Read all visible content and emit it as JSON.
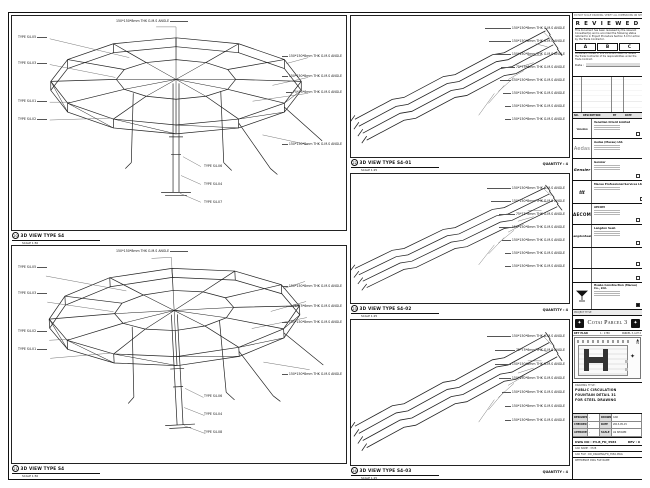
{
  "note": "DO NOT SCALE DRAWING. VERIFY ALL DIMENSIONS ON SITE.",
  "stamp": {
    "title": "R E V I E W E D",
    "body": "This document has been reviewed by the relevant Consultant(s) and is accorded the following status referred to in Project Procedure Section 5.4 for action by the Trade Contractor.",
    "a": "A",
    "b": "B",
    "c": "C",
    "note": "Consultant review of this document does not relieve the Trade Contractor of his responsibilities under the Trade Contract.",
    "date_label": "Date :"
  },
  "rev": {
    "no": "NO.",
    "desc": "DESCRIPTION",
    "by": "BY",
    "date": "DATE"
  },
  "companies": [
    {
      "logo": "Venetian",
      "name": "Venetian Orient Limited"
    },
    {
      "logo": "Aedas",
      "name": "Aedas (Macau) Ltd."
    },
    {
      "logo": "Gensler",
      "name": "Gensler"
    },
    {
      "logo": "ttt",
      "name": "Macau Professional Services Ltd."
    },
    {
      "logo": "AECOM",
      "name": "AECOM"
    },
    {
      "logo": "LangdonSeah",
      "name": "Langdon Seah"
    },
    {
      "logo": "",
      "name": ""
    },
    {
      "logo": "",
      "name": ""
    },
    {
      "logo": "",
      "name": "Hsabo Construction (Macau) Co., Ltd."
    }
  ],
  "project": {
    "label": "PROJECT TITLE",
    "name": "Cotai Parcel 3",
    "emblem": "✦"
  },
  "keyplan": {
    "label": "KEY PLAN",
    "scale": "1 : 1750",
    "parcel": "PARCEL 3, LOT 2",
    "north": "N",
    "north_arrow": "▲",
    "star": "✦"
  },
  "dtitle": {
    "label": "DRAWING TITLE :",
    "line1": "PUBLIC CIRCULATION",
    "line2": "FOUNTAIN DETAIL 31",
    "line3": "FOR STEEL DRAWING"
  },
  "meta": {
    "designed_l": "DESIGNED",
    "designed_v": "-",
    "drawn_l": "DRAWN",
    "drawn_v": "CAD",
    "checked_l": "CHECKED",
    "checked_v": "-",
    "date_l": "DATE",
    "date_v": "2013-05-15",
    "approved_l": "APPROVED",
    "approved_v": "-",
    "scale_l": "SCALE",
    "scale_v": "AS SHOWN"
  },
  "dwg": {
    "no_l": "DWG NO :",
    "no_v": "P3-B_FD_3584",
    "rev_l": "REV :",
    "rev_v": "0",
    "cad1": "CAD NAME : 3728",
    "cad2": "CAD FILE : DD_DRAWING/FD_3584.DWG",
    "cad3": "REFERENCE DWG FILE NAME"
  },
  "panels": {
    "p20": {
      "num": "20",
      "title": "3D VIEW TYPE S4",
      "scale": "SCALE 1:50",
      "top": "150*150*8mm THK G.M.S ANGLE",
      "left": [
        "TYPE S4-05",
        "TYPE S4-03",
        "TYPE S4-01",
        "TYPE S4-02"
      ],
      "right": [
        "150*150*8mm THK G.M.S ANGLE",
        "150*150*8mm THK G.M.S ANGLE",
        "75*75*6mm THK G.M.S ANGLE",
        "150*150*8mm THK G.M.S ANGLE"
      ],
      "bottom": [
        "TYPE S4-06",
        "TYPE S4-04",
        "TYPE S4-07"
      ]
    },
    "p21": {
      "num": "21",
      "title": "3D VIEW TYPE S4",
      "scale": "SCALE 1:50",
      "top": "150*150*8mm THK G.M.S ANGLE",
      "left": [
        "TYPE S4-05",
        "TYPE S4-03",
        "TYPE S4-02",
        "TYPE S4-01"
      ],
      "right": [
        "150*150*8mm THK G.M.S ANGLE",
        "75*75*6mm THK G.M.S ANGLE",
        "150*150*8mm THK G.M.S ANGLE",
        "150*150*8mm THK G.M.S ANGLE"
      ],
      "bottom": [
        "TYPE S4-06",
        "TYPE S4-04",
        "TYPE S4-08"
      ]
    },
    "p22": {
      "num": "22",
      "title": "3D VIEW TYPE S4-01",
      "scale": "SCALE 1:25",
      "quantity": "QUANTITY : 4",
      "callouts": [
        "150*150*8mm THK G.M.S ANGLE",
        "150*150*8mm THK G.M.S ANGLE",
        "150*150*8mm THK G.M.S ANGLE",
        "75*75*6mm THK G.M.S ANGLE",
        "150*150*8mm THK G.M.S ANGLE",
        "150*150*8mm THK G.M.S ANGLE",
        "150*150*8mm THK G.M.S ANGLE",
        "150*150*8mm THK G.M.S ANGLE"
      ]
    },
    "p23": {
      "num": "23",
      "title": "3D VIEW TYPE S4-02",
      "scale": "SCALE 1:25",
      "quantity": "QUANTITY : 4",
      "callouts": [
        "150*150*8mm THK G.M.S ANGLE",
        "150*150*8mm THK G.M.S ANGLE",
        "75*75*6mm THK G.M.S ANGLE",
        "150*150*8mm THK G.M.S ANGLE",
        "150*150*8mm THK G.M.S ANGLE",
        "150*150*8mm THK G.M.S ANGLE",
        "150*150*8mm THK G.M.S ANGLE"
      ]
    },
    "p24": {
      "num": "24",
      "title": "3D VIEW TYPE S4-03",
      "scale": "SCALE 1:25",
      "quantity": "QUANTITY : 4",
      "callouts": [
        "150*150*8mm THK G.M.S ANGLE",
        "75*75*6mm THK G.M.S ANGLE",
        "150*150*8mm THK G.M.S ANGLE",
        "150*150*8mm THK G.M.S ANGLE",
        "150*150*8mm THK G.M.S ANGLE",
        "150*150*8mm THK G.M.S ANGLE",
        "150*150*8mm THK G.M.S ANGLE"
      ]
    }
  }
}
